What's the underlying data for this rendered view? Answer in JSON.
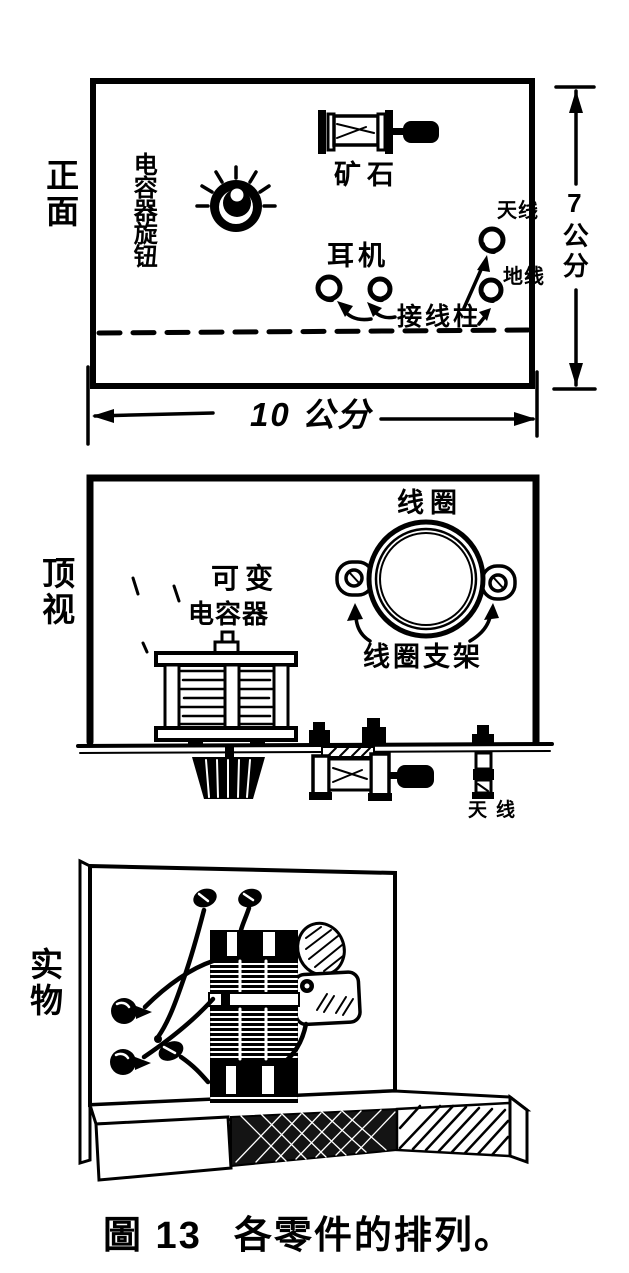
{
  "figure": {
    "caption_no": "圖 13",
    "caption_title": "各零件的排列。"
  },
  "front_view": {
    "side_label": "正面",
    "knob_label": "电容器旋钮",
    "crystal_label": "矿石",
    "earphone_label": "耳机",
    "antenna_label": "天线",
    "ground_label": "地线",
    "binding_post_label": "接线柱",
    "height_dim": "7公分",
    "width_dim": "10 公分"
  },
  "top_view": {
    "side_label": "顶视",
    "coil_label": "线圈",
    "variable_capacitor_label_1": "可变",
    "variable_capacitor_label_2": "电容器",
    "coil_bracket_label": "线圈支架",
    "antenna_label": "天线"
  },
  "physical_view": {
    "side_label": "实物"
  },
  "colors": {
    "paper": "#ffffff",
    "ink": "#000000"
  }
}
